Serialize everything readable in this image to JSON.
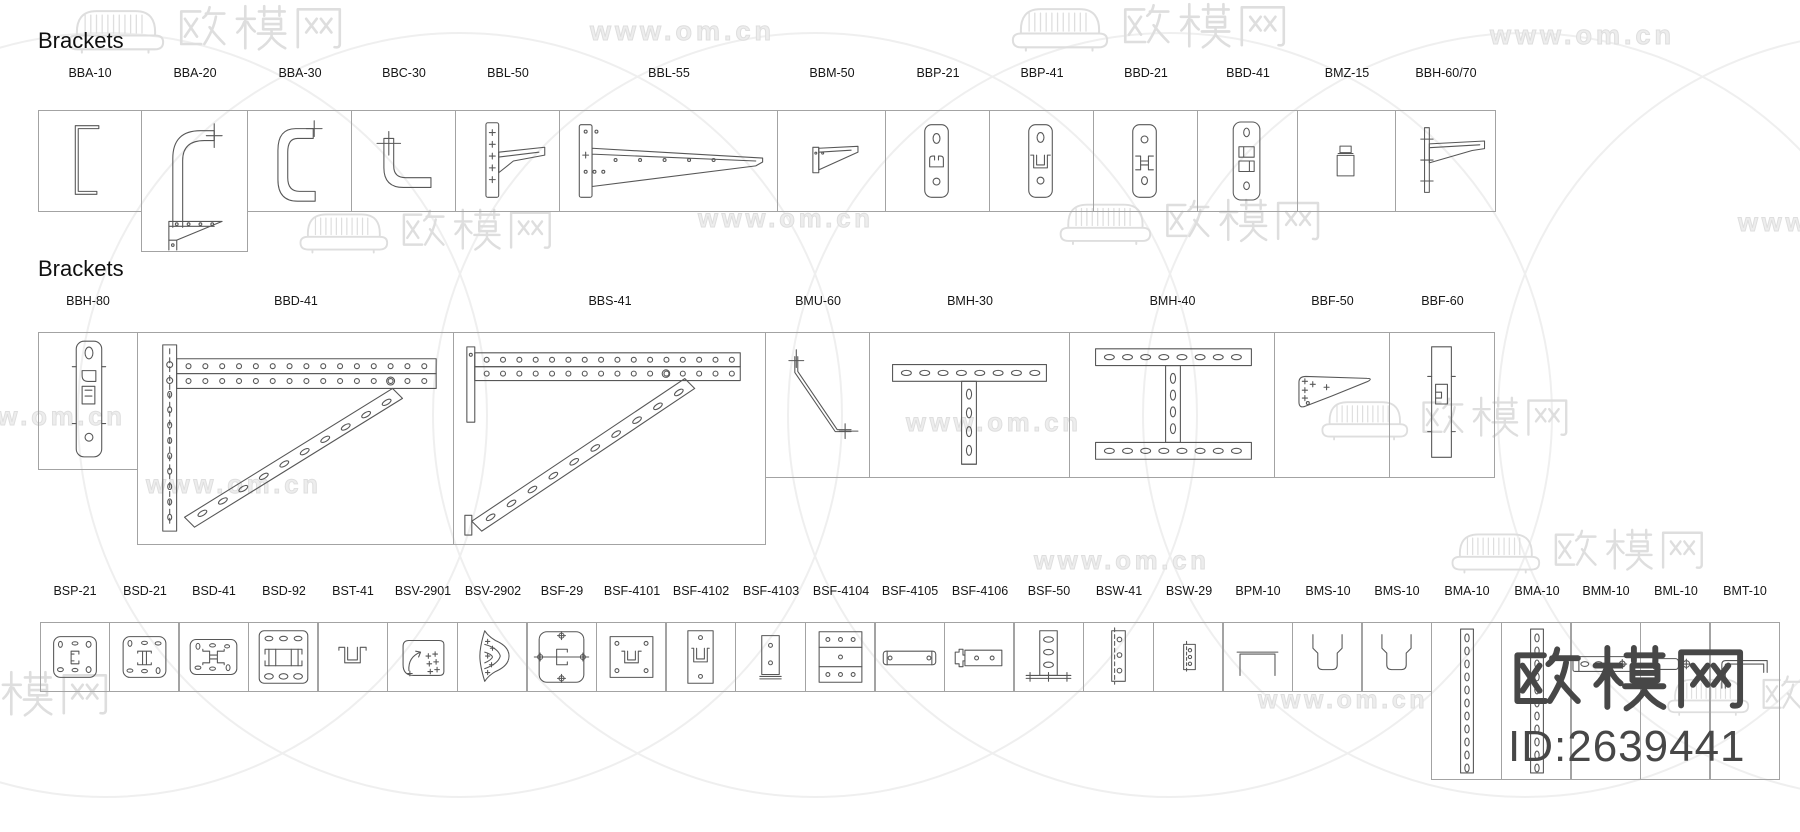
{
  "page": {
    "section1_title": "Brackets",
    "section2_title": "Brackets"
  },
  "sections": [
    {
      "labels": [
        "BBA-10",
        "BBA-20",
        "BBA-30",
        "BBC-30",
        "BBL-50",
        "BBL-55",
        "BBM-50",
        "BBP-21",
        "BBP-41",
        "BBD-21",
        "BBD-41",
        "BMZ-15",
        "BBH-60/70"
      ]
    },
    {
      "labels": [
        "BBH-80",
        "BBD-41",
        "BBS-41",
        "BMU-60",
        "BMH-30",
        "BMH-40",
        "BBF-50",
        "BBF-60"
      ]
    },
    {
      "labels": [
        "BSP-21",
        "BSD-21",
        "BSD-41",
        "BSD-92",
        "BST-41",
        "BSV-2901",
        "BSV-2902",
        "BSF-29",
        "BSF-4101",
        "BSF-4102",
        "BSF-4103",
        "BSF-4104",
        "BSF-4105",
        "BSF-4106",
        "BSF-50",
        "BSW-41",
        "BSW-29",
        "BPM-10",
        "BMS-10",
        "BMS-10",
        "BMA-10",
        "BMA-10",
        "BMM-10",
        "BML-10",
        "BMT-10"
      ]
    }
  ],
  "watermark": {
    "site_url": "www.om.cn",
    "brand": "欧模网",
    "id_label": "ID:2639441",
    "light_color": "#dedede",
    "dark_color": "#474747"
  }
}
